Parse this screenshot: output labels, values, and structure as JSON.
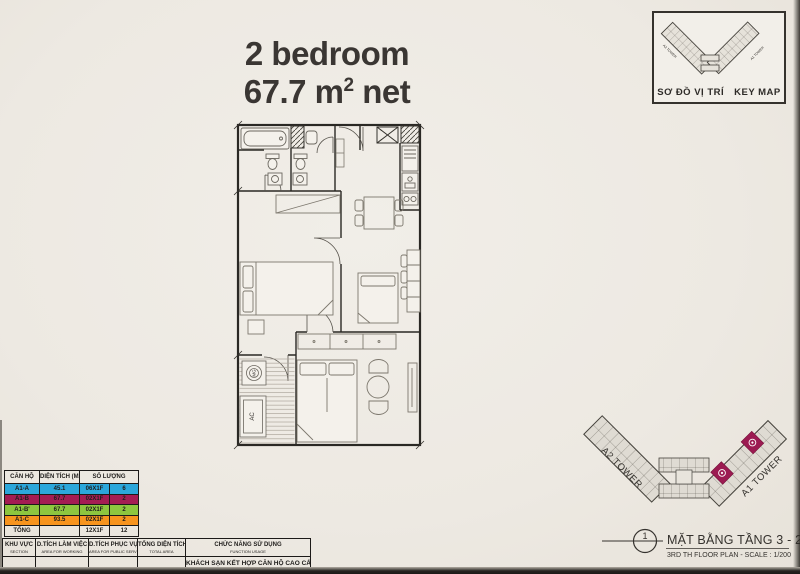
{
  "page": {
    "background": "#EFECE5"
  },
  "title": {
    "line1": "2 bedroom",
    "area_prefix": "67.7 m",
    "area_sup": "2",
    "area_suffix": " net"
  },
  "keymap": {
    "title_vi": "SƠ ĐỒ VỊ TRÍ",
    "title_en": "KEY MAP"
  },
  "towers": {
    "a2": "A2 TOWER",
    "a1": "A1 TOWER"
  },
  "plan": {
    "washer_label": "MG",
    "ac_label": "AC"
  },
  "unit_table": {
    "col_unit": "CĂN HỘ",
    "col_area": "DIỆN TÍCH (M2)",
    "col_qty": "SỐ LƯỢNG",
    "rows": [
      {
        "unit": "A1-A",
        "area": "45.1",
        "qty_per_floor": "06X1F",
        "qty": "6",
        "color": "#2BA7DB"
      },
      {
        "unit": "A1-B",
        "area": "67.7",
        "qty_per_floor": "02X1F",
        "qty": "2",
        "color": "#A41C53"
      },
      {
        "unit": "A1-B'",
        "area": "67.7",
        "qty_per_floor": "02X1F",
        "qty": "2",
        "color": "#8DC63F"
      },
      {
        "unit": "A1-C",
        "area": "93.5",
        "qty_per_floor": "02X1F",
        "qty": "2",
        "color": "#F7941E"
      }
    ],
    "total_label": "TỔNG",
    "total_area": "",
    "total_qty_per_floor": "12X1F",
    "total_qty": "12"
  },
  "section_table": {
    "col1_vi": "KHU VỰC",
    "col1_en": "SECTION",
    "col2_vi": "D.TÍCH LÀM VIỆC",
    "col2_en": "AREA FOR WORKING",
    "col3_vi": "D.TÍCH PHỤC VỤ",
    "col3_en": "AREA FOR PUBLIC SERVICE",
    "col4_vi": "TỔNG DIỆN TÍCH",
    "col4_en": "TOTAL AREA",
    "col5_vi": "CHỨC NĂNG SỬ DỤNG",
    "col5_en": "FUNCTION USAGE",
    "function_value": "KHÁCH SẠN KẾT HỢP CĂN HỘ CAO CẤP"
  },
  "titleblock": {
    "detail_number": "1",
    "title_vi": "MẶT BẰNG TẦNG 3 - 24",
    "title_en": "3RD TH FLOOR PLAN  - SCALE : 1/200"
  },
  "highlight": {
    "color": "#9C1B52"
  }
}
